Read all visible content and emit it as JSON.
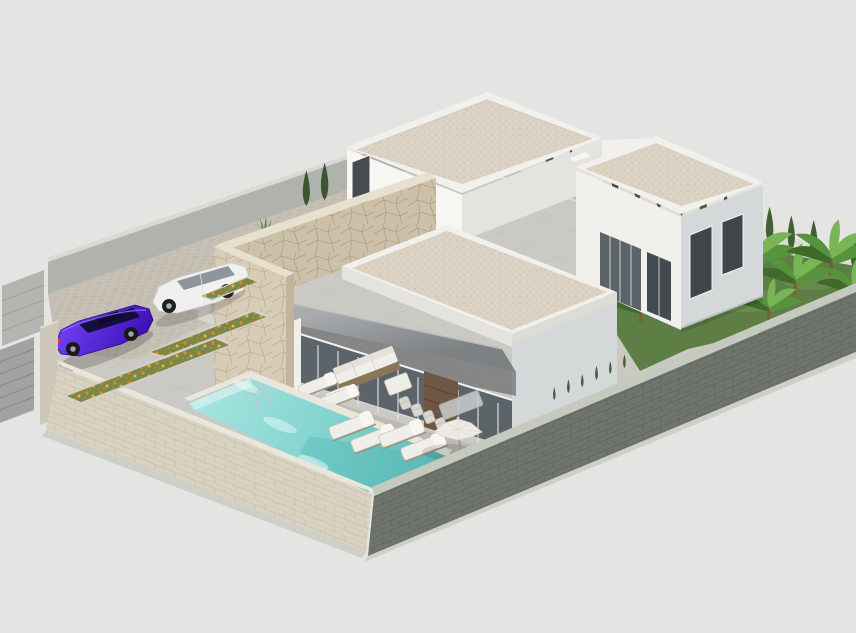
{
  "meta": {
    "title": "Aerial isometric 3D render of a modern single-storey villa with pool",
    "type": "architectural-visualization",
    "view": "isometric-aerial",
    "width_px": 856,
    "height_px": 633
  },
  "palette": {
    "bg": "#e4e5e2",
    "wall_inner": "#b0b2ad",
    "wall_cap_back": "#d9dad3",
    "back_wall": "#dcded6",
    "wall_light_base": "#d8d2c0",
    "wall_light_cap": "#ebe7d8",
    "wall_dark_base": "#6f746d",
    "wall_dark_cap": "#c6c9bd",
    "apron": "#cfcfca",
    "ground": "#cac9c3",
    "cobble": "#c6c0b5",
    "slab": "#d7d5cf",
    "white_lit": "#f7f6f2",
    "white_mid": "#f1f0ec",
    "white_shade": "#e4e3df",
    "gray_face": "#d5d8d8",
    "gravel": "#dbd2c3",
    "stone_lit": "#d8ccb8",
    "stone_shade": "#cdc0a9",
    "stone_cap": "#e7e0cf",
    "awning_light": "#a9acae",
    "awning_dark": "#7d8183",
    "glass": "#5c646a",
    "glass_dark": "#434b50",
    "door_wood": "#6e5843",
    "pool_coping": "#e9e6dc",
    "water_light": "#a5e4df",
    "water_mid": "#7fd2cd",
    "water_deep": "#58b8b6",
    "grass": "#5d7f46",
    "leaf_dark": "#3f6a2c",
    "leaf_mid": "#57923c",
    "leaf_light": "#79b557",
    "cypress": "#416035",
    "flower_orange": "#e08a1e",
    "flower_amber": "#eeb53e",
    "planter_green": "#77884c",
    "car_purple": "#4a1acc",
    "car_purple_deep": "#32079e",
    "car_white": "#f0f1ef",
    "furniture_white": "#efeeea",
    "wood_frame": "#8b7658"
  },
  "scene": {
    "background": "#e4e5e2",
    "objects": [
      {
        "name": "perimeter-wall-front-left",
        "material": "light beige brick",
        "note": "encloses plot, gate at west corner"
      },
      {
        "name": "perimeter-wall-front-right",
        "material": "dark grey brick"
      },
      {
        "name": "perimeter-wall-back",
        "material": "light render with cypress hedge behind"
      },
      {
        "name": "entrance-gate",
        "material": "grey metal panels with pillar"
      },
      {
        "name": "driveway-parking",
        "material": "cobblestone paving",
        "vehicles": 2
      },
      {
        "name": "car-purple-sedan",
        "color": "#4a1acc"
      },
      {
        "name": "car-white-suv",
        "color": "#f0f1ef"
      },
      {
        "name": "flower-planters",
        "count": 3,
        "flowers": "orange and amber blooms"
      },
      {
        "name": "stepping-stone-path",
        "slabs": 4
      },
      {
        "name": "stone-feature-wall",
        "material": "cream flagstone cladding, L-shaped entry volume"
      },
      {
        "name": "building-block-rear-left",
        "roof": "flat gravel roof with white parapet"
      },
      {
        "name": "building-block-rear-right",
        "roof": "flat gravel roof",
        "windows": "dark glazing on two facades"
      },
      {
        "name": "building-block-living",
        "feature": "covered terrace with grey awning and glass wall"
      },
      {
        "name": "terrace",
        "material": "large format grey tiles"
      },
      {
        "name": "outdoor-sofa-set",
        "cushions": "white"
      },
      {
        "name": "dining-set",
        "chairs": 4
      },
      {
        "name": "sun-loungers",
        "count": 6
      },
      {
        "name": "parasol",
        "color": "white"
      },
      {
        "name": "swimming-pool",
        "water": "turquoise",
        "ladder": "chrome"
      },
      {
        "name": "lawn-right-garden",
        "plants": "banana palms"
      },
      {
        "name": "cypress-hedge",
        "rows": "along rear boundary"
      }
    ]
  }
}
